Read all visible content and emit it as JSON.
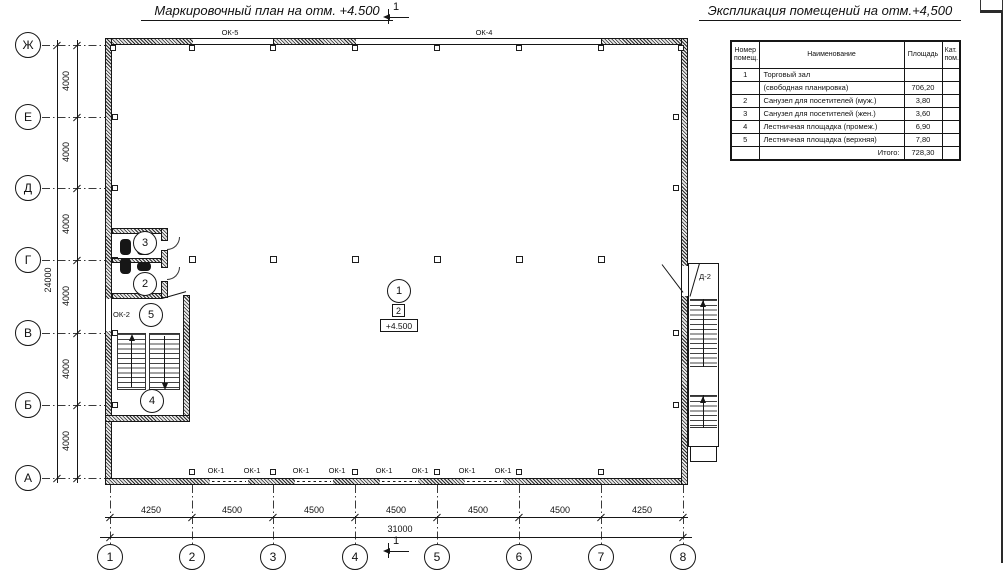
{
  "titles": {
    "plan": "Маркировочный план на отм. +4.500",
    "schedule": "Экспликация помещений на отм.+4,500"
  },
  "section_mark": {
    "label": "1"
  },
  "schedule_table": {
    "headers": {
      "num": "Номер помещ.",
      "name": "Наименование",
      "area": "Площадь",
      "cat": "Кат. пом."
    },
    "rows": [
      {
        "num": "1",
        "name": "Торговый зал",
        "area": "",
        "cat": ""
      },
      {
        "num": "",
        "name": "(свободная планировка)",
        "area": "706,20",
        "cat": ""
      },
      {
        "num": "2",
        "name": "Санузел для посетителей (муж.)",
        "area": "3,80",
        "cat": ""
      },
      {
        "num": "3",
        "name": "Санузел для посетителей (жен.)",
        "area": "3,60",
        "cat": ""
      },
      {
        "num": "4",
        "name": "Лестничная площадка (промеж.)",
        "area": "6,90",
        "cat": ""
      },
      {
        "num": "5",
        "name": "Лестничная площадка (верхняя)",
        "area": "7,80",
        "cat": ""
      },
      {
        "num": "",
        "name": "Итого:",
        "area": "728,30",
        "cat": ""
      }
    ]
  },
  "grid": {
    "rows": [
      "Ж",
      "Е",
      "Д",
      "Г",
      "В",
      "Б",
      "А"
    ],
    "cols": [
      "1",
      "2",
      "3",
      "4",
      "5",
      "6",
      "7",
      "8"
    ]
  },
  "dimensions": {
    "left_bays": [
      "4000",
      "4000",
      "4000",
      "4000",
      "4000",
      "4000"
    ],
    "left_total": "24000",
    "bottom_bays": [
      "4250",
      "4500",
      "4500",
      "4500",
      "4500",
      "4500",
      "4250"
    ],
    "bottom_total": "31000"
  },
  "plan_labels": {
    "top_windows": [
      "ОК-5",
      "ОК-4"
    ],
    "bottom_windows": [
      "ОК-1",
      "ОК-1",
      "ОК-1",
      "ОК-1",
      "ОК-1",
      "ОК-1",
      "ОК-1",
      "ОК-1"
    ],
    "left_window": "ОК-2",
    "right_door": "Д-2",
    "room_marks": [
      "1",
      "2",
      "3",
      "4",
      "5"
    ],
    "floor_type_mark": "2",
    "elevation_mark": "+4.500"
  },
  "colors": {
    "ink": "#161616",
    "paper": "#ffffff"
  }
}
